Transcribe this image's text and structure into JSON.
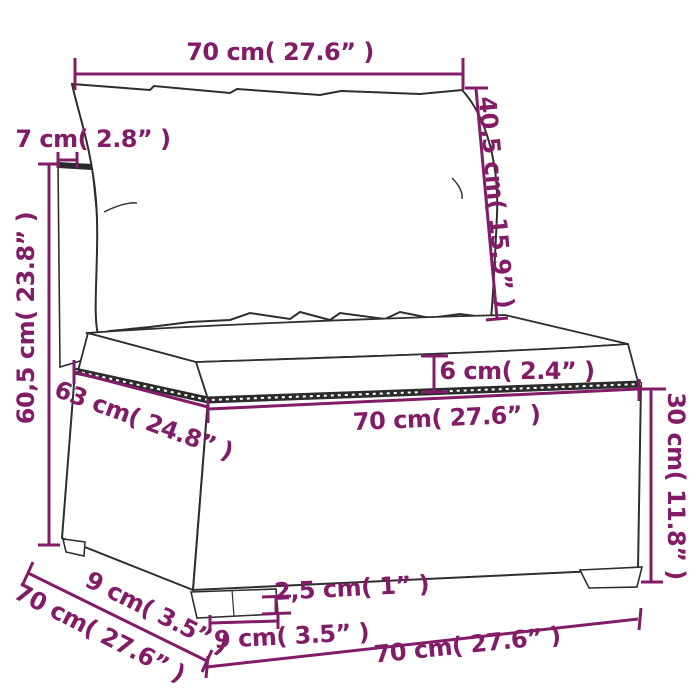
{
  "colors": {
    "dimension_accent": "#821c66",
    "line_art": "#2e2e2e",
    "background": "#ffffff",
    "cushion_fill": "#ffffff"
  },
  "dimensions": {
    "back_width_top": "70 cm( 27.6”  )",
    "back_panel_thickness": "7 cm( 2.8”  )",
    "back_cushion_height": "40,5 cm( 15.9”  )",
    "total_height": "60,5 cm( 23.8”  )",
    "seat_depth": "63 cm( 24.8”  )",
    "seat_cushion_thickness": "6 cm( 2.4”  )",
    "seat_front_width": "70 cm( 27.6”  )",
    "base_height": "30 cm( 11.8”  )",
    "depth_side": "9 cm( 3.5”  )",
    "total_depth": "70 cm( 27.6”  )",
    "foot_width": "9 cm( 3.5”  )",
    "foot_height": "2,5 cm( 1”  )",
    "total_width_bottom": "70 cm( 27.6”  )"
  }
}
